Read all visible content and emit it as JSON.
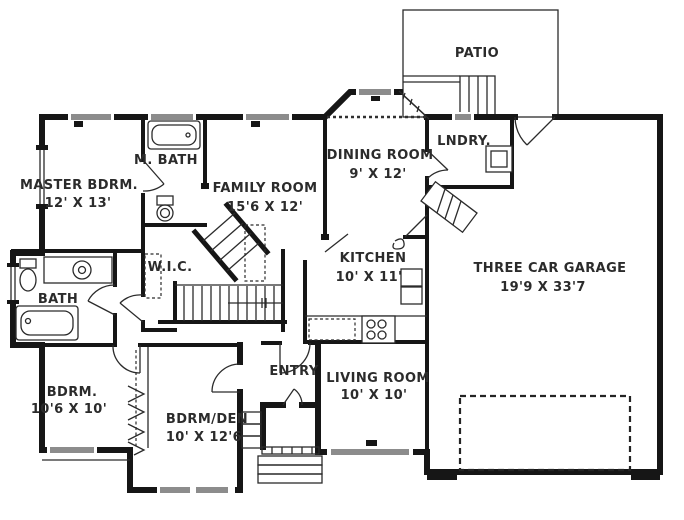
{
  "plan": {
    "title": "single-story house floor plan",
    "rooms": {
      "patio": {
        "label": "PATIO"
      },
      "master_bdrm": {
        "label": "MASTER BDRM.",
        "dims": "12' X 13'"
      },
      "m_bath": {
        "label": "M. BATH"
      },
      "family_room": {
        "label": "FAMILY ROOM",
        "dims": "15'6 X 12'"
      },
      "dining_room": {
        "label": "DINING ROOM",
        "dims": "9' X 12'"
      },
      "lndry": {
        "label": "LNDRY."
      },
      "kitchen": {
        "label": "KITCHEN",
        "dims": "10' X 11'"
      },
      "garage": {
        "label": "THREE CAR GARAGE",
        "dims": "19'9 X 33'7"
      },
      "wic": {
        "label": "W.I.C."
      },
      "bath": {
        "label": "BATH"
      },
      "bdrm": {
        "label": "BDRM.",
        "dims": "10'6 X 10'"
      },
      "bdrm_den": {
        "label": "BDRM/DEN",
        "dims": "10' X 12'6"
      },
      "entry": {
        "label": "ENTRY"
      },
      "living_room": {
        "label": "LIVING ROOM",
        "dims": "10' X 10'"
      }
    },
    "colors": {
      "wall": "#161616",
      "thin_line": "#2b2b2b",
      "window_fill": "#8c8c8c",
      "text": "#2b2b2b",
      "background": "#ffffff"
    }
  }
}
